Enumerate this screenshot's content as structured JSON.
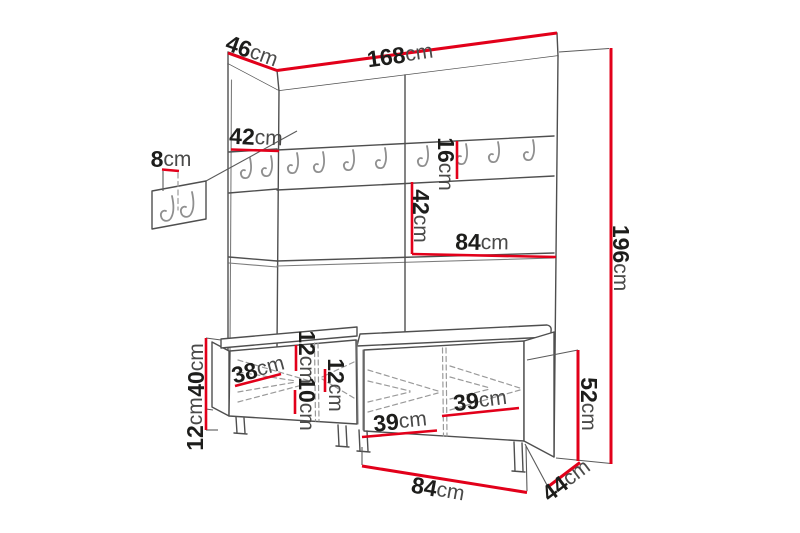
{
  "figure": {
    "kind": "furniture dimension line drawing",
    "colors": {
      "dimension_red": "#e2001a",
      "outline_gray": "#4f4f4f",
      "hook_gray": "#8f8f8f",
      "number_text": "#1d1d1b",
      "unit_text": "#4a4a49",
      "background": "#ffffff"
    }
  },
  "dims": {
    "top_width": {
      "value": "168",
      "unit": "cm"
    },
    "top_depth": {
      "value": "46",
      "unit": "cm"
    },
    "left_column_width": {
      "value": "42",
      "unit": "cm"
    },
    "wall_panel_width": {
      "value": "8",
      "unit": "cm"
    },
    "total_height": {
      "value": "196",
      "unit": "cm"
    },
    "hook_rail_height": {
      "value": "16",
      "unit": "cm"
    },
    "mid_section_height": {
      "value": "42",
      "unit": "cm"
    },
    "mid_section_width": {
      "value": "84",
      "unit": "cm"
    },
    "bench_door_width": {
      "value": "38",
      "unit": "cm"
    },
    "bench_top_gap": {
      "value": "12",
      "unit": "cm"
    },
    "bench_bottom_gap": {
      "value": "10",
      "unit": "cm"
    },
    "bench_middle_gap": {
      "value": "12",
      "unit": "cm"
    },
    "seat_height": {
      "value": "40",
      "unit": "cm"
    },
    "plinth_height": {
      "value": "12",
      "unit": "cm"
    },
    "drawer_left_width": {
      "value": "39",
      "unit": "cm"
    },
    "drawer_right_width": {
      "value": "39",
      "unit": "cm"
    },
    "bench_height": {
      "value": "52",
      "unit": "cm"
    },
    "bench_width": {
      "value": "84",
      "unit": "cm"
    },
    "bench_depth": {
      "value": "44",
      "unit": "cm"
    }
  }
}
